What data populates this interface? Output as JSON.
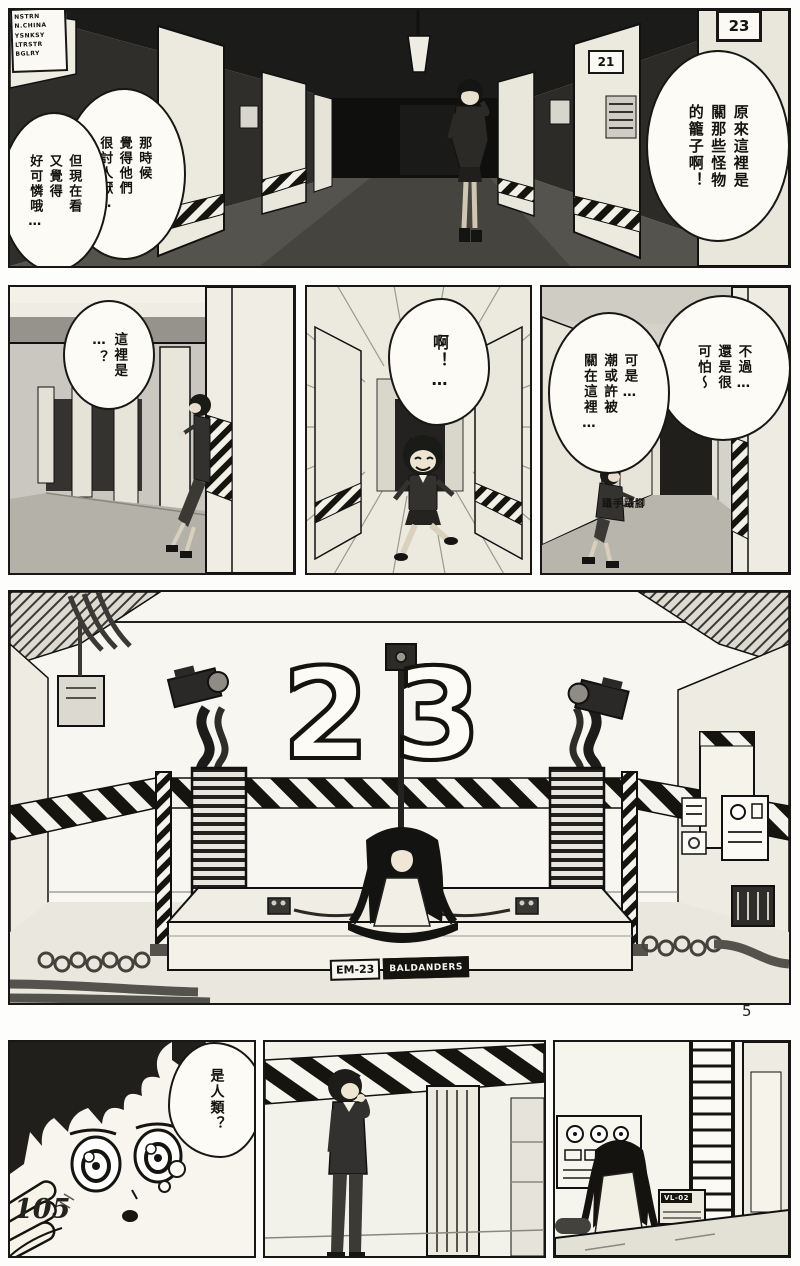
{
  "page": {
    "number": "105",
    "progress_marker": "5"
  },
  "panel1": {
    "wall_sign": "NSTRN\nN.CHINA\nYSNKSY\nLTRSTR\nBGLRY",
    "door_plate_left": "21",
    "door_plate_right": "23",
    "bubble_right": "原來這裡是\n關那些怪物\n的籠子啊！",
    "bubble_left_first": "那時候\n覺得他們\n很討人厭…",
    "bubble_left_second": "但現在看\n又覺得\n好可憐哦…"
  },
  "panel2": {
    "bubble": "這裡是\n…？"
  },
  "panel3": {
    "bubble": "啊！…"
  },
  "panel4": {
    "bubble_right": "不過…\n還是很\n可怕～",
    "bubble_left": "可是…\n潮或許被\n關在這裡…",
    "sfx": "躡手躡腳"
  },
  "panel5": {
    "room_number": "23",
    "sign_model": "EM-23",
    "sign_name": "BALDANDERS"
  },
  "panel6": {
    "thought_bubble": "是人類？"
  },
  "panel8": {
    "console_label": "VL-02"
  },
  "colors": {
    "ink": "#14130f",
    "paper": "#f6f5ef",
    "hazard_dark": "#15140f"
  }
}
